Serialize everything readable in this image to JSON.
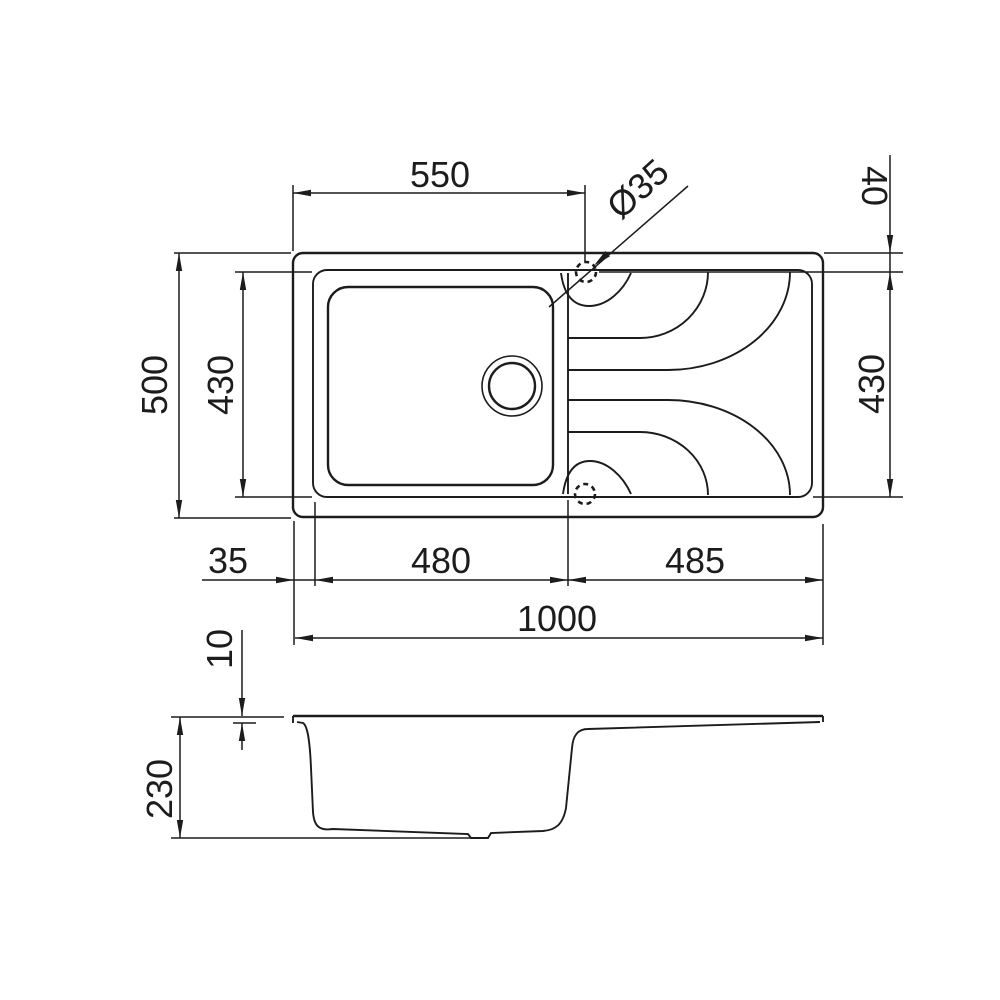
{
  "drawing": {
    "type": "sink-technical-dimension-drawing",
    "background_color": "#ffffff",
    "line_color": "#1c1c1c",
    "views": {
      "plan_view": "top view of sink with bowl, drainer grooves, two tap holes and drain",
      "side_view": "cross-section profile of sink bowl and drainer"
    },
    "labels": {
      "top_width": "550",
      "hole_diameter": "Ø35",
      "hole_edge_offset": "40",
      "overall_depth": "500",
      "inner_depth_left": "430",
      "inner_depth_right": "430",
      "left_rim": "35",
      "bowl_width": "480",
      "drainer_width": "485",
      "overall_width": "1000",
      "rim_thickness": "10",
      "bowl_depth": "230"
    }
  }
}
